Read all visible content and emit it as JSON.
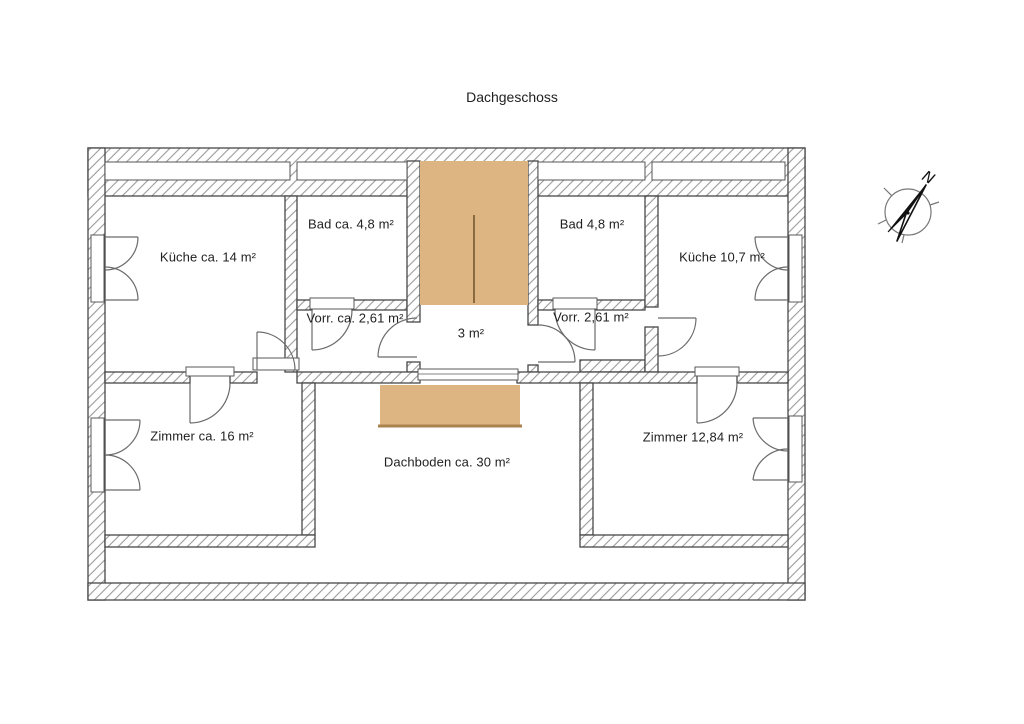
{
  "title": "Dachgeschoss",
  "rooms": [
    {
      "name": "kueche-links",
      "label": "Küche ca. 14 m²"
    },
    {
      "name": "bad-links",
      "label": "Bad ca. 4,8 m²"
    },
    {
      "name": "vorraum-links",
      "label": "Vorr. ca. 2,61 m²"
    },
    {
      "name": "flur",
      "label": "3 m²"
    },
    {
      "name": "bad-rechts",
      "label": "Bad 4,8 m²"
    },
    {
      "name": "vorraum-rechts",
      "label": "Vorr. 2,61 m²"
    },
    {
      "name": "kueche-rechts",
      "label": "Küche 10,7 m²"
    },
    {
      "name": "zimmer-links",
      "label": "Zimmer ca. 16 m²"
    },
    {
      "name": "dachboden",
      "label": "Dachboden ca. 30 m²"
    },
    {
      "name": "zimmer-rechts",
      "label": "Zimmer 12,84 m²"
    }
  ],
  "compass": {
    "north_label": "N"
  },
  "colors": {
    "stairs": "#ddb583",
    "stairs_edge": "#a9824e",
    "wall_outline": "#474747",
    "hatch_line": "#9b9b9b",
    "text": "#1f1f1f",
    "background": "#ffffff"
  }
}
